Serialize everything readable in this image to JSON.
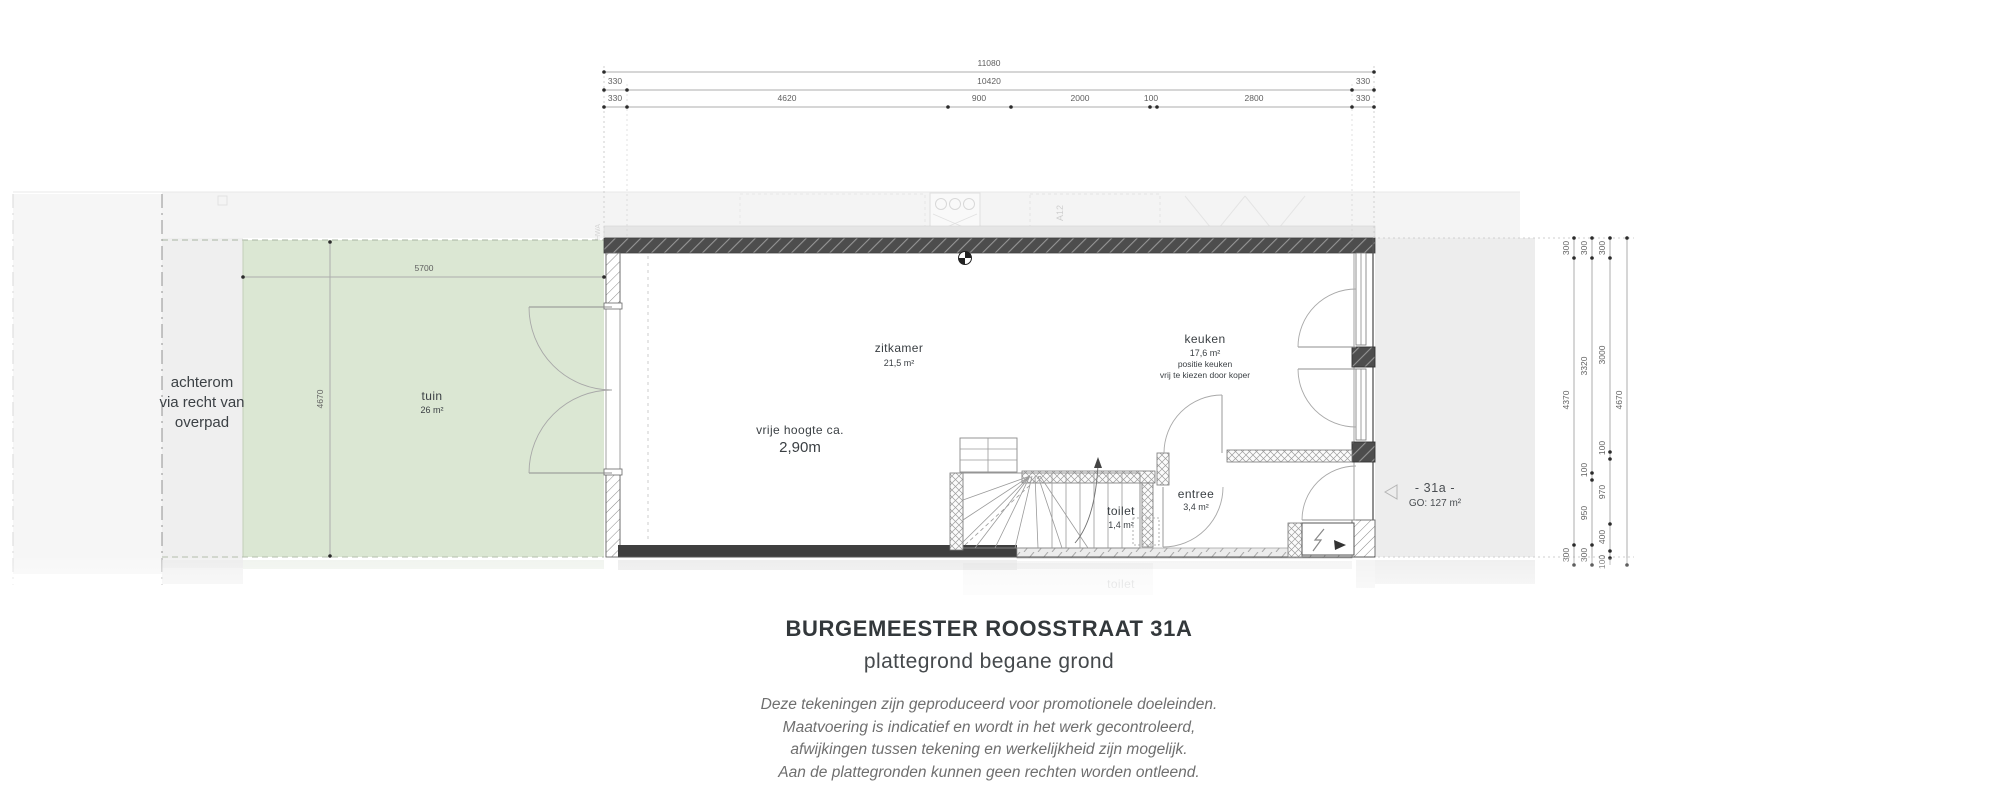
{
  "title_block": {
    "title": "BURGEMEESTER ROOSSTRAAT 31A",
    "subtitle": "plattegrond begane grond",
    "disclaimer": [
      "Deze tekeningen zijn geproduceerd voor promotionele doeleinden.",
      "Maatvoering is indicatief en wordt in het werk gecontroleerd,",
      "afwijkingen tussen tekening en werkelijkheid zijn mogelijk.",
      "Aan de plattegronden kunnen geen rechten worden ontleend."
    ]
  },
  "top_dims": {
    "total": "11080",
    "row2": [
      "330",
      "10420",
      "330"
    ],
    "row3": [
      "330",
      "4620",
      "900",
      "2000",
      "100",
      "2800",
      "330"
    ]
  },
  "right_dims": {
    "chain_inner": [
      "300",
      "4370",
      "300"
    ],
    "chain_middle": [
      "300",
      "3320",
      "100",
      "950",
      "300"
    ],
    "chain_outer": [
      "300",
      "3000",
      "100",
      "970",
      "400",
      "100"
    ],
    "total": "4670"
  },
  "garden_dims": {
    "width": "5700",
    "depth": "4670"
  },
  "labels": {
    "access": [
      "achterom",
      "via recht van",
      "overpad"
    ],
    "tuin": {
      "name": "tuin",
      "area": "26 m²"
    },
    "zitkamer": {
      "name": "zitkamer",
      "area": "21,5 m²"
    },
    "keuken": {
      "name": "keuken",
      "area": "17,6 m²",
      "note1": "positie keuken",
      "note2": "vrij te kiezen door koper"
    },
    "toilet": {
      "name": "toilet",
      "area": "1,4 m²"
    },
    "entree": {
      "name": "entree",
      "area": "3,4 m²"
    },
    "height_note": [
      "vrije hoogte ca.",
      "2,90m"
    ],
    "neighbor": {
      "name": "- 31a -",
      "area": "GO: 127 m²"
    },
    "adjacent_marker": "A12",
    "drainpipe_marker": "HWA"
  },
  "colors": {
    "garden": "#dbe7d3",
    "neighbor_bg": "#ededed",
    "wall_dark": "#4d4d4d",
    "text": "#3c4145"
  }
}
